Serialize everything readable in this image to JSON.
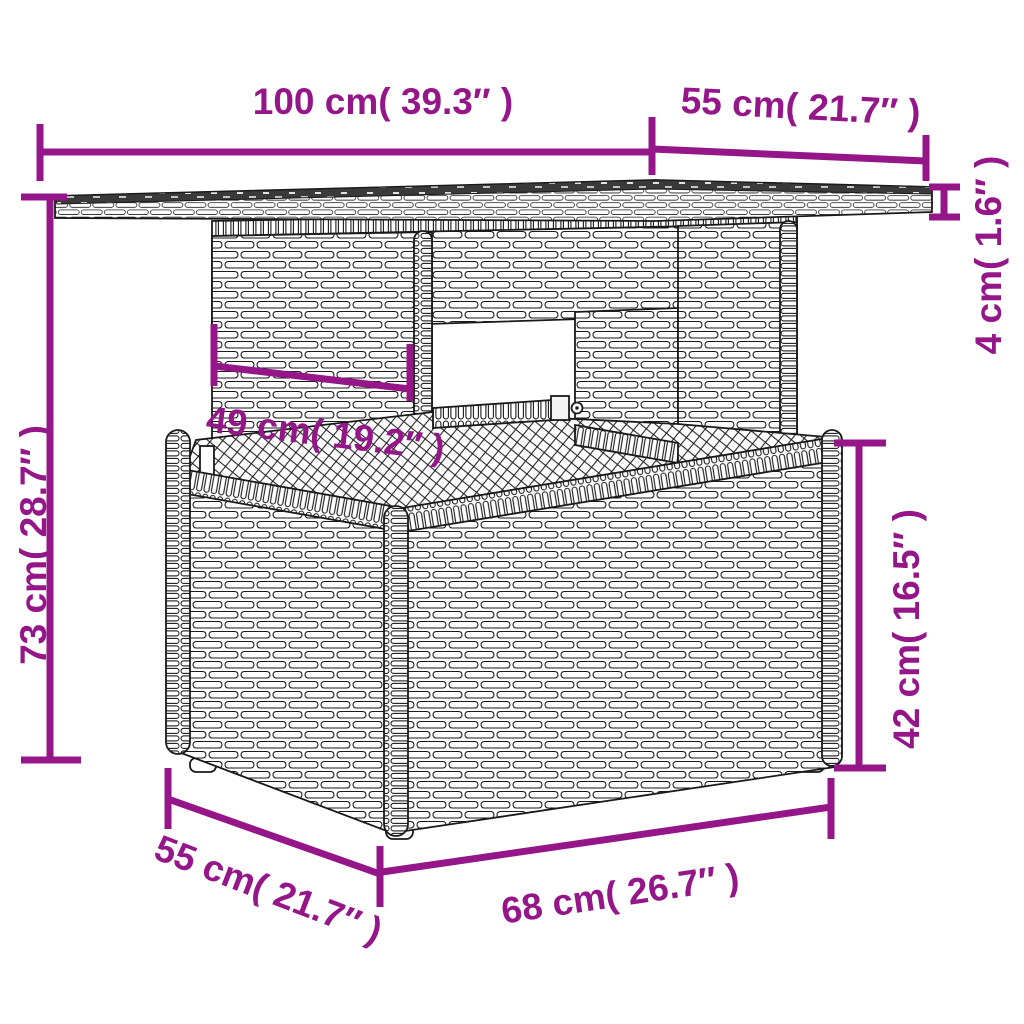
{
  "diagram": {
    "colors": {
      "dimension": "#951688",
      "outline": "#1a1a1a",
      "tabletop_surface": "#3a3a3a",
      "weave_fill": "#ffffff"
    },
    "dimensions": {
      "tabletop_width": {
        "label": "100 cm( 39.3″ )"
      },
      "tabletop_depth": {
        "label": "55 cm( 21.7″ )"
      },
      "tabletop_thickness": {
        "label": "4 cm( 1.6″ )"
      },
      "total_height": {
        "label": "73 cm( 28.7″ )"
      },
      "pedestal_width": {
        "label": "49 cm( 19.2″ )"
      },
      "base_height": {
        "label": "42 cm( 16.5″ )"
      },
      "base_depth": {
        "label": "55 cm( 21.7″ )"
      },
      "base_width": {
        "label": "68 cm( 26.7″ )"
      }
    }
  }
}
